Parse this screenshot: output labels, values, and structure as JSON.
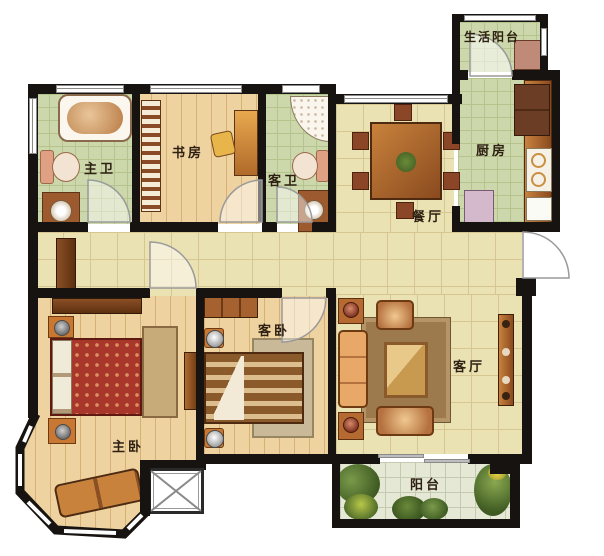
{
  "rooms": {
    "service_balcony": {
      "label": "生活阳台"
    },
    "kitchen": {
      "label": "厨房"
    },
    "dining": {
      "label": "餐厅"
    },
    "master_bath": {
      "label": "主卫"
    },
    "study": {
      "label": "书房"
    },
    "guest_bath": {
      "label": "客卫"
    },
    "guest_bedroom": {
      "label": "客卧"
    },
    "living_room": {
      "label": "客厅"
    },
    "master_bedroom": {
      "label": "主卧"
    },
    "balcony": {
      "label": "阳台"
    }
  },
  "colors": {
    "wall": "#171310",
    "tile_green": "#ccd8ab",
    "tile_beige": "#ebe2b4",
    "wood_floor": "#eed2a0",
    "balcony_floor": "#e6e8d6",
    "furniture_brown": "#a5612f",
    "bed_red": "#a8362a"
  }
}
